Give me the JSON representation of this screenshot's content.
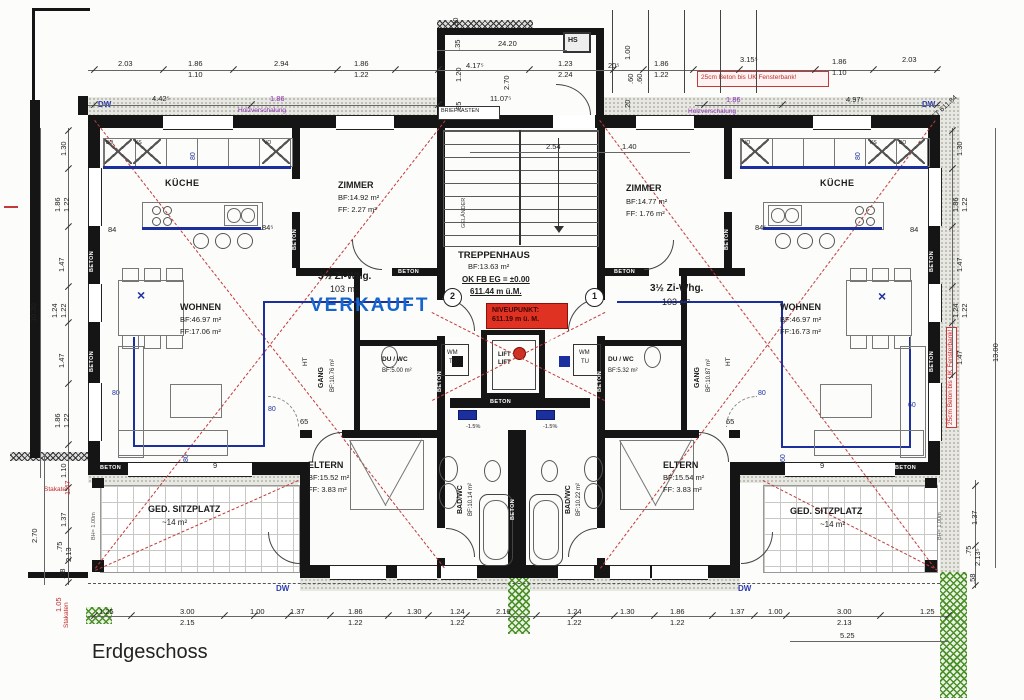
{
  "title": "Erdgeschoss",
  "apartment_left": {
    "type": "3½ Zi-Whg.",
    "area": "103 m²",
    "status": "VERKAUFT",
    "unit_no": "2"
  },
  "apartment_right": {
    "type": "3½ Zi-Whg.",
    "area": "103 m²",
    "unit_no": "1"
  },
  "rooms": {
    "kueche_left": "KÜCHE",
    "kueche_right": "KÜCHE",
    "zimmer_left": {
      "name": "ZIMMER",
      "bf": "BF:14.92 m²",
      "ff": "FF: 2.27 m²"
    },
    "zimmer_right": {
      "name": "ZIMMER",
      "bf": "BF:14.77 m²",
      "ff": "FF: 1.76 m²"
    },
    "wohnen_left": {
      "name": "WOHNEN",
      "bf": "BF:46.97 m²",
      "ff": "FF:17.06 m²"
    },
    "wohnen_right": {
      "name": "WOHNEN",
      "bf": "BF:46.97 m²",
      "ff": "FF:16.73 m²"
    },
    "gang_left": {
      "name": "GANG",
      "bf": "BF:10.76 m²"
    },
    "gang_right": {
      "name": "GANG",
      "bf": "BF:10.87 m²"
    },
    "duwc_left": {
      "name": "DU / WC",
      "bf": "BF:5.00 m²"
    },
    "duwc_right": {
      "name": "DU / WC",
      "bf": "BF:5.32 m²"
    },
    "eltern_left": {
      "name": "ELTERN",
      "bf": "BF:15.52 m²",
      "ff": "FF: 3.83 m²"
    },
    "eltern_right": {
      "name": "ELTERN",
      "bf": "BF:15.54 m²",
      "ff": "FF: 3.83 m²"
    },
    "badwc_left": {
      "name": "BAD/WC",
      "bf": "BF:10.14 m²"
    },
    "badwc_right": {
      "name": "BAD/WC",
      "bf": "BF:10.22 m²"
    },
    "sitzplatz_left": {
      "name": "GED. SITZPLATZ",
      "area": "~14 m²"
    },
    "sitzplatz_right": {
      "name": "GED. SITZPLATZ",
      "area": "~14 m²"
    },
    "treppenhaus": {
      "name": "TREPPENHAUS",
      "bf": "BF:13.63 m²",
      "level": "OK FB EG = ±0.00",
      "elevation": "611.44 m ü.M."
    }
  },
  "niveupunkt": {
    "line1": "NIVEUPUNKT:",
    "line2": "611.19 m ü. M."
  },
  "labels": {
    "beton": "BETON",
    "lift": "LIFT",
    "hs": "HS",
    "briefkasten": "BRIEFKASTEN",
    "gelaender": "GELÄNDER",
    "wm": "WM",
    "tu": "TU",
    "ht": "HT",
    "dw": "DW",
    "holz": "Holzverschalung",
    "beton_note": "25cm Beton bis UK Fensterbank!",
    "stakaten": "Stakaten",
    "gt": "GT 611.84",
    "slope": "-1.5%",
    "bh": "BH= 1.00m",
    "xmark": "×"
  },
  "cabinets_left": [
    "BO",
    "KS",
    "VO"
  ],
  "cabinets_right": [
    "VO",
    "KS",
    "BO"
  ],
  "dims_top": [
    "2.03",
    "1.86",
    "1.10",
    "2.94",
    "1.86",
    "1.22",
    "4.17⁵",
    "1.23",
    "2.24",
    "20⁵",
    "1.86",
    "1.22",
    "3.15⁵",
    "1.86",
    "1.10",
    "2.03"
  ],
  "dims_top2": [
    "4.42⁵",
    "1.86",
    "11.07⁵",
    "1.86",
    "4.97⁵"
  ],
  "dims_small": [
    ".30",
    ".35",
    "1.20",
    ".85",
    "24.20",
    "2.70",
    "1.00",
    ".60",
    ".60",
    ".20",
    "2.54",
    "1.40"
  ],
  "dims_left": [
    "1.30",
    "1.86",
    "1.22",
    "1.47",
    "1.24",
    "1.22",
    "1.47",
    "10.30",
    "1.86",
    "1.22",
    "1.10",
    "1.47",
    "1.37",
    "2.70",
    ".75",
    "2.13",
    ".58",
    "1.05"
  ],
  "dims_right": [
    "1.30",
    "1.86",
    "1.22",
    "1.47",
    "1.24",
    "1.22",
    "1.47",
    "13.00",
    "1.37",
    ".75",
    "2.13⁵",
    ".58"
  ],
  "dims_bottom": [
    "1.25",
    "3.00",
    "2.15",
    "1.00",
    "1.37",
    "1.86",
    "1.22",
    "1.30",
    "1.24",
    "1.22",
    "2.16",
    "1.24",
    "1.22",
    "1.30",
    "1.86",
    "1.22",
    "1.37",
    "1.00",
    "3.00",
    "2.13",
    "1.25",
    "5.25"
  ],
  "dims_plan": [
    "84",
    "84⁵",
    "84⁵",
    "84",
    "65",
    "65",
    "9",
    "9"
  ],
  "pipes": [
    "80",
    "80",
    "80",
    "80",
    "80",
    "80",
    "60",
    "60"
  ]
}
